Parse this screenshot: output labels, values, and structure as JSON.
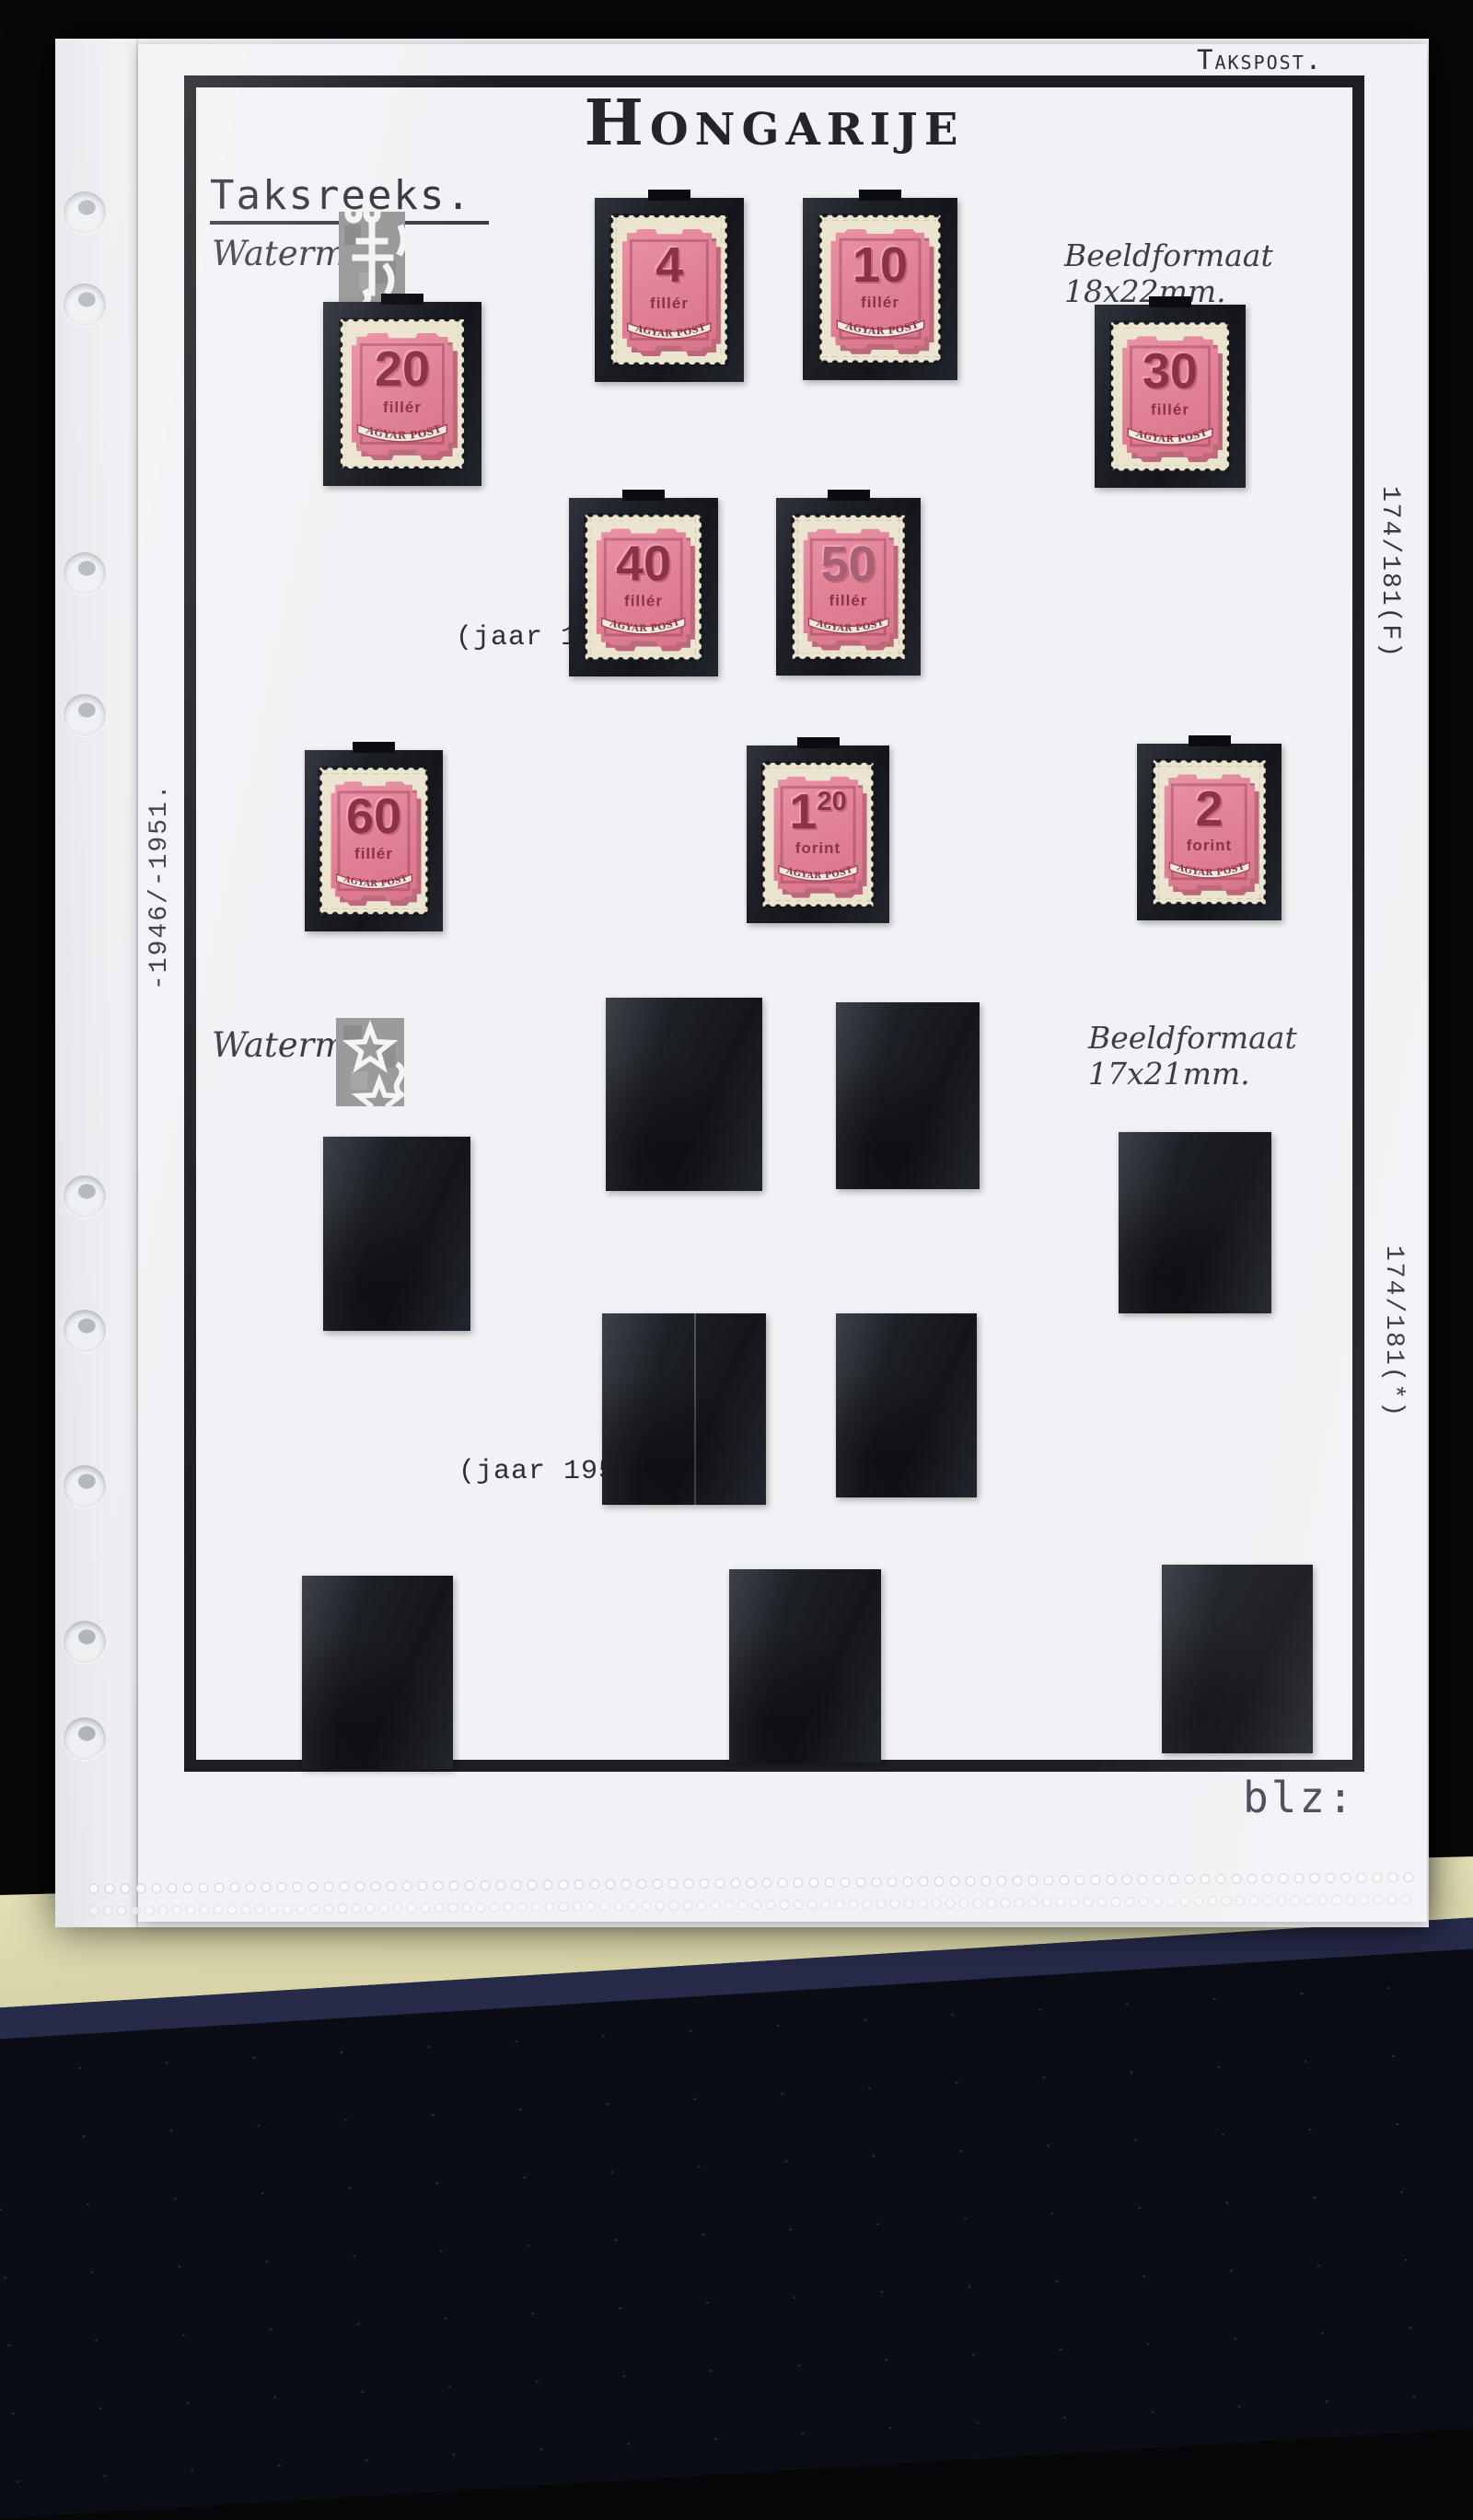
{
  "photo": {
    "background_color": "#07070a",
    "fabric_color": "#0b0d15",
    "fabric_edge_color": "#262b49",
    "album_edge_color": "#d7d3a6",
    "binder_hole_count": 9
  },
  "page": {
    "corner_label": "Takspost.",
    "title": "Hongarije",
    "series_heading": "Taksreeks.",
    "side_label_left": "-1946/-1951.",
    "footer_label": "blz:",
    "sections": [
      {
        "watermark_label": "Watermerk",
        "watermark_symbol": "double-cross-watermark",
        "format_note": "Beeldformaat 18x22mm.",
        "year_note": "(jaar 1951)",
        "side_label_right": "174/181(F)"
      },
      {
        "watermark_label": "Watermerk",
        "watermark_symbol": "star-watermark",
        "format_note": "Beeldformaat 17x21mm.",
        "year_note": "(jaar 1951)",
        "side_label_right": "174/181(*)"
      }
    ]
  },
  "stamps": {
    "banner_label": "MAGYAR POSTA",
    "colors": {
      "paper": "#ebe4cf",
      "pink": "#e07f95",
      "carmine": "#8c3148",
      "mount_black": "#17191f"
    },
    "items": [
      {
        "value": "4",
        "unit": "fillér"
      },
      {
        "value": "10",
        "unit": "fillér"
      },
      {
        "value": "20",
        "unit": "fillér"
      },
      {
        "value": "30",
        "unit": "fillér"
      },
      {
        "value": "40",
        "unit": "fillér"
      },
      {
        "value": "50",
        "unit": "fillér"
      },
      {
        "value": "60",
        "unit": "fillér"
      },
      {
        "value": "1",
        "value_sup": "20",
        "unit": "forint"
      },
      {
        "value": "2",
        "unit": "forint"
      }
    ],
    "empty_mount_count": 9
  }
}
